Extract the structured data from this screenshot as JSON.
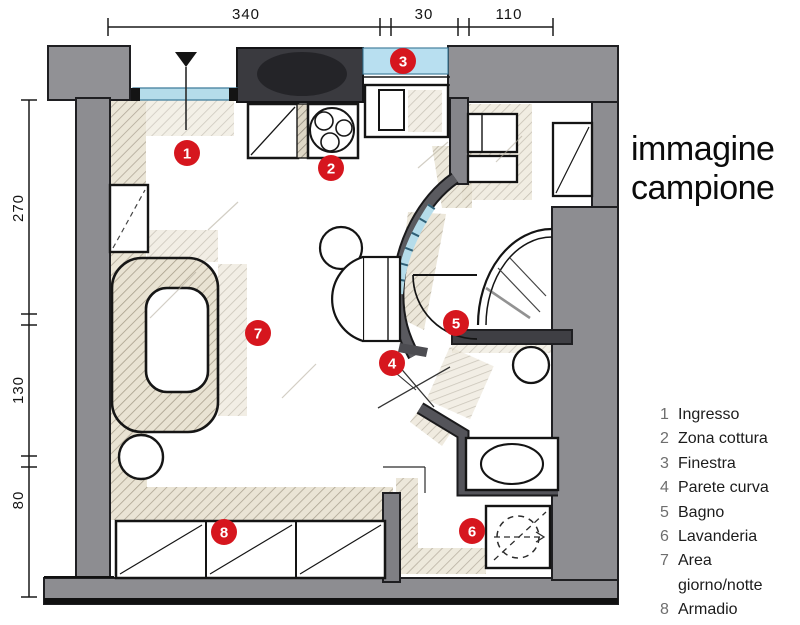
{
  "title": {
    "line1": "immagine",
    "line2": "campione"
  },
  "dimensions": {
    "top": [
      "340",
      "30",
      "110"
    ],
    "left": [
      "270",
      "130",
      "80"
    ]
  },
  "markers": [
    {
      "n": "1",
      "label": "Ingresso"
    },
    {
      "n": "2",
      "label": "Zona cottura"
    },
    {
      "n": "3",
      "label": "Finestra"
    },
    {
      "n": "4",
      "label": "Parete curva"
    },
    {
      "n": "5",
      "label": "Bagno"
    },
    {
      "n": "6",
      "label": "Lavanderia"
    },
    {
      "n": "7",
      "label": "Area giorno/notte"
    },
    {
      "n": "8",
      "label": "Armadio"
    }
  ],
  "legend": {
    "items": [
      {
        "num": "1",
        "label": "Ingresso"
      },
      {
        "num": "2",
        "label": "Zona cottura"
      },
      {
        "num": "3",
        "label": "Finestra"
      },
      {
        "num": "4",
        "label": "Parete curva"
      },
      {
        "num": "5",
        "label": "Bagno"
      },
      {
        "num": "6",
        "label": "Lavanderia"
      },
      {
        "num": "7",
        "label": "Area giorno/notte"
      },
      {
        "num": "8",
        "label": "Armadio"
      }
    ]
  },
  "colors": {
    "marker_red": "#d6161e",
    "wall_gray": "#8d8d91",
    "glass_blue": "#b5dcea",
    "hatch_beige": "#e9e3d3"
  }
}
